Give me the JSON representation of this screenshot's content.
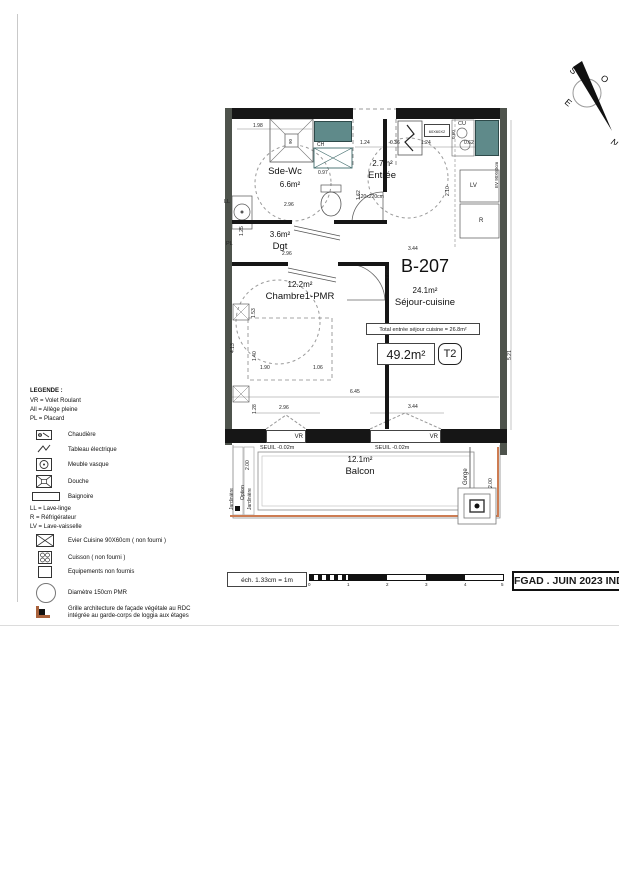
{
  "unit": {
    "id": "B-207",
    "sejour_area": "24.1m²",
    "sejour_name": "Séjour-cuisine",
    "total_note": "Total entrée séjour cuisine = 26.8m²",
    "total_area": "49.2m²",
    "type": "T2"
  },
  "rooms": {
    "sdewc": {
      "name": "Sde-Wc",
      "area": "6.6m²"
    },
    "entree": {
      "name": "Entrée",
      "area": "2.7m²",
      "door_size": "120x220cm"
    },
    "dgt": {
      "name": "Dgt",
      "area": "3.6m²"
    },
    "chambre": {
      "name": "Chambre1-PMR",
      "area": "12.2m²"
    },
    "balcon": {
      "name": "Balcon",
      "area": "12.1m²"
    }
  },
  "fixtures": {
    "ch": "CH",
    "cu": "CU",
    "lv": "LV",
    "r": "R",
    "ll": "LL",
    "pl": "PL",
    "vr": "VR",
    "ev": "EV 90X60cm",
    "hob": "60X60X2",
    "shower": "90",
    "seuil": "SEUIL -0.02m",
    "gorge": "Gorge",
    "jardiniere": "Jardinière",
    "option": "Option"
  },
  "dims": {
    "shower_top": "1.98",
    "wc_w": "0.97",
    "sdewc_h": "1.62",
    "sdewc_w": "2.96",
    "dgt_h": "1.25",
    "dgt_w": "2.96",
    "entree_top": "1.24",
    "k_036": "0.36",
    "k_124": "1.24",
    "k_062": "0.62",
    "cu_d": "0.60",
    "k_210": "2.10",
    "sejour_top": "3.44",
    "sejour_h": "7.88",
    "ch_153": "1.53",
    "ch_413": "4.13",
    "ch_140": "1.40",
    "bed_w": "1.90",
    "bed_r": "1.06",
    "ch_128": "1.28",
    "inner_w": "6.45",
    "win1": "2.96",
    "win2": "3.44",
    "right_h": "5.21",
    "balc_l": "2.00",
    "balc_r": "2.00"
  },
  "legend": {
    "title": "LEGENDE :",
    "items": [
      {
        "label": "VR = Volet Roulant"
      },
      {
        "label": "All = Allège pleine"
      },
      {
        "label": "PL = Placard"
      },
      {
        "label": "Chaudière"
      },
      {
        "label": "Tableau électrique"
      },
      {
        "label": "Meuble vasque"
      },
      {
        "label": "Douche"
      },
      {
        "label": "Baignoire"
      },
      {
        "label": "LL = Lave-linge"
      },
      {
        "label": "R = Réfrigérateur"
      },
      {
        "label": "LV = Lave-vaisselle"
      },
      {
        "label": "Evier Cuisine 90X60cm ( non fourni )"
      },
      {
        "label": "Cuisson ( non fourni )"
      },
      {
        "label": "Equipements non fournis"
      },
      {
        "label": "Diamètre 150cm PMR"
      },
      {
        "label": "Grille architecture de façade végétale au RDC intégrée au garde-corps de loggia aux étages"
      }
    ]
  },
  "scalebar": {
    "label": "éch. 1.33cm = 1m",
    "ticks": [
      "0",
      "1",
      "2",
      "3",
      "4",
      "5"
    ]
  },
  "titleblock": {
    "text": "FGAD . JUIN 2023 IND"
  },
  "compass": {
    "n": "N",
    "s": "S",
    "e": "E",
    "o": "O"
  }
}
